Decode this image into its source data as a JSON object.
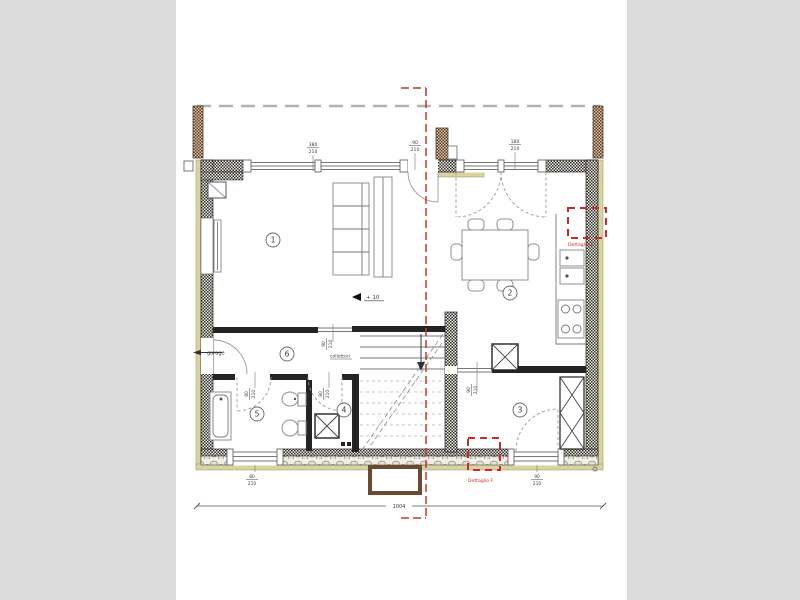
{
  "scene": {
    "kind": "architectural-floor-plan",
    "sheet": "white drawing sheet centered on gray canvas"
  },
  "colors": {
    "canvas_bg": "#dcdcdc",
    "sheet_bg": "#ffffff",
    "wall_dark": "#242424",
    "line_gray": "#8a8a8a",
    "khaki": "#d8d3a0",
    "brown": "#6b4a2f",
    "section_red": "#c0392b",
    "detail_red": "#cc2a2a",
    "dim_text": "#3a3a3a"
  },
  "rooms": [
    {
      "number": "1"
    },
    {
      "number": "2"
    },
    {
      "number": "3"
    },
    {
      "number": "4"
    },
    {
      "number": "5"
    },
    {
      "number": "6"
    }
  ],
  "annotations": {
    "garage": "garage",
    "level": "+ 10",
    "manifold": "collettori"
  },
  "details": {
    "top_right": "Dettaglio E",
    "bottom": "Dettaglio F"
  },
  "dimensions": {
    "overall_width": "1004",
    "top": [
      {
        "w": "380",
        "h": "210"
      },
      {
        "w": "90",
        "h": "210"
      },
      {
        "w": "180",
        "h": "210"
      }
    ],
    "interior": [
      {
        "w": "90",
        "h": "210"
      },
      {
        "w": "80",
        "h": "210"
      },
      {
        "w": "80",
        "h": "210"
      },
      {
        "w": "90",
        "h": "210"
      }
    ],
    "bottom": [
      {
        "w": "80",
        "h": "210"
      },
      {
        "w": "90",
        "h": "210"
      }
    ]
  }
}
